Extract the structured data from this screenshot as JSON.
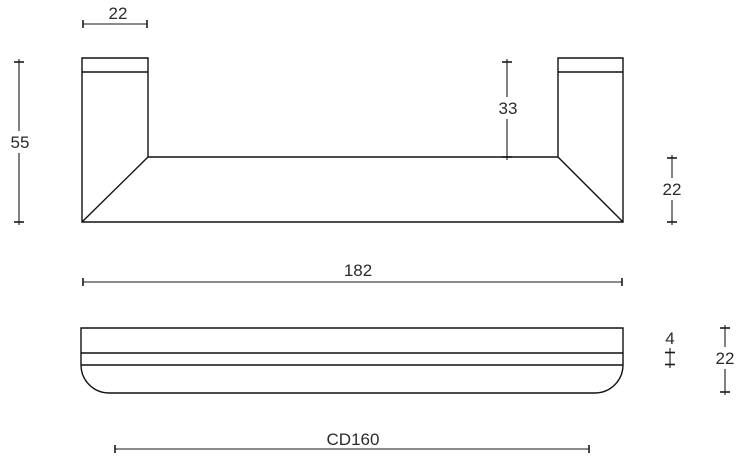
{
  "drawing": {
    "kind": "furniture-handle-technical-drawing",
    "colors": {
      "background": "#ffffff",
      "line": "#111111",
      "text": "#2b2b2b"
    },
    "dimensions": {
      "post_width": "22",
      "overall_height": "55",
      "post_inner_height": "33",
      "bar_depth": "22",
      "overall_length": "182",
      "edge_step": "4",
      "bar_thickness": "22",
      "centre_distance": "CD160"
    }
  }
}
